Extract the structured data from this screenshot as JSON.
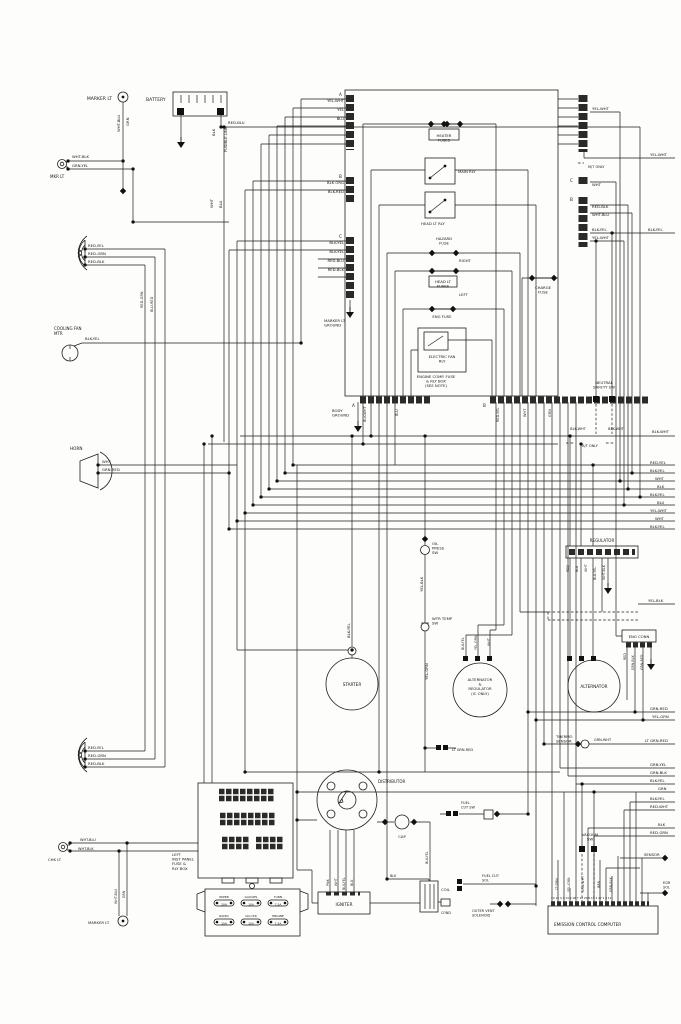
{
  "diagram_type": "automotive wiring diagram",
  "subject": "Engine compartment wiring: battery, engine comp fuse & relay box, starter, alternators, distributor, igniter, emission control computer",
  "diagram": {
    "labels": [
      {
        "n": "marker-lt-top-label",
        "t": "MARKER LT",
        "x": 112,
        "y": 100,
        "a": "e"
      },
      {
        "n": "mkr-lt-label",
        "t": "MKR LT",
        "x": 50,
        "y": 178,
        "s": 4
      },
      {
        "t": "WHT-BLK",
        "x": 72,
        "y": 158,
        "s": 3.8
      },
      {
        "t": "GRN-YEL",
        "x": 72,
        "y": 167,
        "s": 3.8
      },
      {
        "n": "battery-label",
        "t": "BATTERY",
        "x": 146,
        "y": 101
      },
      {
        "t": "RED-BLU",
        "x": 228,
        "y": 124,
        "s": 3.8
      },
      {
        "t": "WHT-BLU",
        "x": 120,
        "y": 132,
        "r": 1,
        "s": 3.8
      },
      {
        "t": "GRN",
        "x": 129,
        "y": 126,
        "r": 1,
        "s": 3.8
      },
      {
        "t": "BLK",
        "x": 215,
        "y": 136,
        "r": 1,
        "s": 3.8
      },
      {
        "t": "FUSIBLE LINK",
        "x": 227,
        "y": 152,
        "r": 1,
        "s": 3.8
      },
      {
        "t": "WHT",
        "x": 213,
        "y": 208,
        "r": 1,
        "s": 3.8
      },
      {
        "t": "BLU",
        "x": 222,
        "y": 208,
        "r": 1,
        "s": 3.8
      },
      {
        "t": "RED-YEL",
        "x": 88,
        "y": 247,
        "s": 3.8
      },
      {
        "t": "RED-GRN",
        "x": 88,
        "y": 255,
        "s": 3.8
      },
      {
        "t": "RED-BLK",
        "x": 88,
        "y": 263,
        "s": 3.8
      },
      {
        "n": "cooling-fan-label",
        "L": [
          "COOLING FAN",
          "MTR"
        ],
        "x": 54,
        "y": 330,
        "s": 4
      },
      {
        "t": "BLK-YEL",
        "x": 85,
        "y": 340,
        "s": 3.8
      },
      {
        "n": "horn-label",
        "t": "HORN",
        "x": 70,
        "y": 450,
        "s": 4.2
      },
      {
        "t": "WHT",
        "x": 102,
        "y": 463,
        "s": 3.8
      },
      {
        "t": "GRN-RED",
        "x": 102,
        "y": 471,
        "s": 3.8
      },
      {
        "t": "A",
        "x": 339,
        "y": 96,
        "s": 4.2
      },
      {
        "t": "YEL-WHT",
        "x": 344,
        "y": 102,
        "a": "e",
        "s": 3.8
      },
      {
        "t": "YEL",
        "x": 344,
        "y": 111,
        "a": "e",
        "s": 3.8
      },
      {
        "t": "BLU",
        "x": 344,
        "y": 120,
        "a": "e",
        "s": 3.8
      },
      {
        "t": "B",
        "x": 339,
        "y": 178,
        "s": 4.2
      },
      {
        "t": "BLK ORG",
        "x": 344,
        "y": 184,
        "a": "e",
        "s": 3.8
      },
      {
        "t": "BLK-RED",
        "x": 344,
        "y": 193,
        "a": "e",
        "s": 3.8
      },
      {
        "t": "C",
        "x": 339,
        "y": 238,
        "s": 4.2
      },
      {
        "t": "BLK-YEL",
        "x": 344,
        "y": 244,
        "a": "e",
        "s": 3.8
      },
      {
        "t": "BLK-YEL",
        "x": 344,
        "y": 253,
        "a": "e",
        "s": 3.8
      },
      {
        "t": "RED-BLU",
        "x": 344,
        "y": 262,
        "a": "e",
        "s": 3.8
      },
      {
        "t": "RED-BLK",
        "x": 344,
        "y": 271,
        "a": "e",
        "s": 3.8
      },
      {
        "n": "marker-lt-ground-label",
        "L": [
          "MARKER LT",
          "GROUND"
        ],
        "x": 324,
        "y": 322,
        "s": 3.8
      },
      {
        "n": "heater-fuses-label",
        "L": [
          "HEATER",
          "FUSES"
        ],
        "x": 444,
        "y": 137,
        "a": "m",
        "s": 3.8
      },
      {
        "n": "main-relay-label",
        "t": "MAIN RLY",
        "x": 458,
        "y": 173,
        "s": 3.8
      },
      {
        "n": "headlight-relay-label",
        "t": "HEAD LT RLY",
        "x": 421,
        "y": 225,
        "s": 3.8
      },
      {
        "n": "hazard-fuse-label",
        "L": [
          "HAZARD",
          "FUSE"
        ],
        "x": 444,
        "y": 240,
        "a": "m",
        "s": 3.8
      },
      {
        "t": "RIGHT",
        "x": 459,
        "y": 262,
        "s": 3.8
      },
      {
        "n": "headlight-fuses-label",
        "L": [
          "HEAD LT",
          "FUSES"
        ],
        "x": 443,
        "y": 283,
        "a": "m",
        "s": 3.8
      },
      {
        "t": "LEFT",
        "x": 459,
        "y": 296,
        "s": 3.8
      },
      {
        "n": "engine-fuse-label",
        "t": "ENG FUSE",
        "x": 442,
        "y": 318,
        "a": "m",
        "s": 3.8
      },
      {
        "n": "electric-fan-relay-label",
        "L": [
          "ELECTRIC FAN",
          "RLY"
        ],
        "x": 442,
        "y": 358,
        "a": "m",
        "s": 3.8
      },
      {
        "n": "engine-comp-box-label",
        "L": [
          "ENGINE COMP. FUSE",
          "& RLY BOX",
          "(SEE NOTE)"
        ],
        "x": 436,
        "y": 378,
        "a": "m",
        "s": 3.8
      },
      {
        "n": "charge-fuse-label",
        "L": [
          "CHARGE",
          "FUSE"
        ],
        "x": 543,
        "y": 289,
        "a": "m",
        "s": 3.8
      },
      {
        "t": "YEL-WHT",
        "x": 592,
        "y": 110,
        "s": 3.8
      },
      {
        "t": "YEL-WHT",
        "x": 650,
        "y": 156,
        "s": 3.8
      },
      {
        "t": "M/T ONLY",
        "x": 588,
        "y": 168,
        "s": 3.5
      },
      {
        "t": "C",
        "x": 570,
        "y": 182,
        "s": 4.2
      },
      {
        "t": "WHT",
        "x": 592,
        "y": 186,
        "s": 3.8
      },
      {
        "t": "B",
        "x": 570,
        "y": 201,
        "s": 4.2
      },
      {
        "t": "RED-BLK",
        "x": 592,
        "y": 208,
        "s": 3.8
      },
      {
        "t": "WHT-BLU",
        "x": 592,
        "y": 216,
        "s": 3.8
      },
      {
        "t": "BLK-YEL",
        "x": 592,
        "y": 231,
        "s": 3.8
      },
      {
        "t": "YEL-WHT",
        "x": 592,
        "y": 239,
        "s": 3.8
      },
      {
        "t": "BLK-YEL",
        "x": 648,
        "y": 231,
        "s": 3.8
      },
      {
        "t": "A",
        "x": 352,
        "y": 407,
        "s": 4.2
      },
      {
        "t": "B",
        "x": 483,
        "y": 407,
        "s": 4.2
      },
      {
        "n": "body-ground-label",
        "L": [
          "BODY",
          "GROUND"
        ],
        "x": 332,
        "y": 412,
        "s": 3.8
      },
      {
        "t": "BLK-WHT",
        "x": 366,
        "y": 422,
        "r": 1,
        "s": 3.5
      },
      {
        "t": "BLU",
        "x": 398,
        "y": 416,
        "r": 1,
        "s": 3.5
      },
      {
        "t": "RED-YEL",
        "x": 499,
        "y": 422,
        "r": 1,
        "s": 3.5
      },
      {
        "t": "WHT",
        "x": 526,
        "y": 417,
        "r": 1,
        "s": 3.5
      },
      {
        "t": "GRN",
        "x": 551,
        "y": 417,
        "r": 1,
        "s": 3.5
      },
      {
        "n": "neutral-safety-sw-label",
        "L": [
          "NEUTRAL",
          "SAFETY SW"
        ],
        "x": 604,
        "y": 384,
        "a": "m",
        "s": 3.8
      },
      {
        "t": "BLK-WHT",
        "x": 578,
        "y": 430,
        "a": "m",
        "s": 3.5
      },
      {
        "t": "BLK-WHT",
        "x": 616,
        "y": 430,
        "a": "m",
        "s": 3.5
      },
      {
        "t": "A/T ONLY",
        "x": 590,
        "y": 447,
        "a": "m",
        "s": 3.5
      },
      {
        "t": "BLK-WHT",
        "x": 652,
        "y": 433,
        "s": 3.8
      },
      {
        "t": "RED-YEL",
        "x": 650,
        "y": 464,
        "s": 3.8
      },
      {
        "t": "BLK-YEL",
        "x": 650,
        "y": 472,
        "s": 3.8
      },
      {
        "t": "WHT",
        "x": 655,
        "y": 480,
        "s": 3.8
      },
      {
        "t": "BLK",
        "x": 657,
        "y": 488,
        "s": 3.8
      },
      {
        "t": "BLK-YEL",
        "x": 650,
        "y": 496,
        "s": 3.8
      },
      {
        "t": "BLU",
        "x": 657,
        "y": 504,
        "s": 3.8
      },
      {
        "t": "YEL-WHT",
        "x": 650,
        "y": 512,
        "s": 3.8
      },
      {
        "t": "WHT",
        "x": 655,
        "y": 520,
        "s": 3.8
      },
      {
        "t": "BLK-YEL",
        "x": 650,
        "y": 528,
        "s": 3.8
      },
      {
        "n": "oil-press-sw-label",
        "L": [
          "OIL",
          "PRESS",
          "SW"
        ],
        "x": 432,
        "y": 545,
        "s": 3.8
      },
      {
        "t": "YEL-BLK",
        "x": 423,
        "y": 592,
        "r": 1,
        "s": 3.8
      },
      {
        "n": "regulator-label",
        "t": "REGULATOR",
        "x": 602,
        "y": 542,
        "a": "m",
        "s": 4
      },
      {
        "t": "RED",
        "x": 569,
        "y": 572,
        "r": 1,
        "s": 3.3
      },
      {
        "t": "BLU",
        "x": 578,
        "y": 572,
        "r": 1,
        "s": 3.3
      },
      {
        "t": "WHT",
        "x": 587,
        "y": 572,
        "r": 1,
        "s": 3.3
      },
      {
        "t": "BLU-YEL",
        "x": 596,
        "y": 580,
        "r": 1,
        "s": 3.3
      },
      {
        "t": "WHT-BLK",
        "x": 605,
        "y": 580,
        "r": 1,
        "s": 3.3
      },
      {
        "t": "YEL-BLK",
        "x": 648,
        "y": 602,
        "s": 3.8
      },
      {
        "n": "water-temp-sw-label",
        "L": [
          "WTR TEMP",
          "SW"
        ],
        "x": 432,
        "y": 620,
        "s": 3.8
      },
      {
        "t": "YEL-GRN",
        "x": 428,
        "y": 680,
        "r": 1,
        "s": 3.8
      },
      {
        "t": "BLK-YEL",
        "x": 350,
        "y": 638,
        "r": 1,
        "s": 3.8
      },
      {
        "n": "starter-label",
        "t": "STARTER",
        "x": 352,
        "y": 686,
        "a": "m",
        "s": 4.2
      },
      {
        "n": "alt-regulator-label",
        "L": [
          "ALTERNATOR",
          "&",
          "REGULATOR",
          "(IC ONLY)"
        ],
        "x": 480,
        "y": 681,
        "a": "m",
        "s": 3.8
      },
      {
        "t": "BLK-YEL",
        "x": 464,
        "y": 650,
        "r": 1,
        "s": 3.3
      },
      {
        "t": "YEL-GRN",
        "x": 477,
        "y": 650,
        "r": 1,
        "s": 3.3
      },
      {
        "t": "WHT",
        "x": 490,
        "y": 646,
        "r": 1,
        "s": 3.3
      },
      {
        "n": "alternator-label",
        "t": "ALTERNATOR",
        "x": 594,
        "y": 688,
        "a": "m",
        "s": 4.2
      },
      {
        "n": "eng-conn-label",
        "t": "ENG CONN",
        "x": 639,
        "y": 638,
        "a": "m",
        "s": 3.8
      },
      {
        "t": "RED",
        "x": 626,
        "y": 660,
        "r": 1,
        "s": 3.3
      },
      {
        "t": "GRN-BLK",
        "x": 634,
        "y": 670,
        "r": 1,
        "s": 3.3
      },
      {
        "t": "GRN-RED",
        "x": 643,
        "y": 670,
        "r": 1,
        "s": 3.3
      },
      {
        "t": "GRN-RED",
        "x": 650,
        "y": 710,
        "s": 3.8
      },
      {
        "t": "YEL-GRN",
        "x": 652,
        "y": 718,
        "s": 3.8
      },
      {
        "n": "thermo-sensor-label",
        "L": [
          "THERMO",
          "SENSOR"
        ],
        "x": 556,
        "y": 738,
        "s": 3.8
      },
      {
        "t": "GRN-WHT",
        "x": 594,
        "y": 741,
        "s": 3.5
      },
      {
        "t": "LT GRN-RED",
        "x": 645,
        "y": 742,
        "s": 3.8
      },
      {
        "t": "LT GRN-RED",
        "x": 452,
        "y": 751,
        "s": 3.5
      },
      {
        "t": "GRN-YEL",
        "x": 650,
        "y": 766,
        "s": 3.8
      },
      {
        "t": "GRN-BLK",
        "x": 650,
        "y": 774,
        "s": 3.8
      },
      {
        "t": "BLK-YEL",
        "x": 650,
        "y": 782,
        "s": 3.8
      },
      {
        "t": "GRN",
        "x": 658,
        "y": 790,
        "s": 3.8
      },
      {
        "t": "BLK-YEL",
        "x": 650,
        "y": 800,
        "s": 3.8
      },
      {
        "t": "RED-WHT",
        "x": 650,
        "y": 808,
        "s": 3.8
      },
      {
        "t": "BLK",
        "x": 658,
        "y": 826,
        "s": 3.8
      },
      {
        "t": "RED-GRN",
        "x": 650,
        "y": 834,
        "s": 3.8
      },
      {
        "n": "vacuum-sw-label",
        "L": [
          "VACUUM",
          "SW"
        ],
        "x": 590,
        "y": 836,
        "a": "m",
        "s": 3.8
      },
      {
        "n": "sensor-label",
        "t": "SENSOR",
        "x": 644,
        "y": 856,
        "s": 3.8
      },
      {
        "n": "egr-sol-label",
        "L": [
          "EGR",
          "SOL"
        ],
        "x": 663,
        "y": 884,
        "s": 3.5
      },
      {
        "t": "LT GRN",
        "x": 558,
        "y": 890,
        "r": 1,
        "s": 3.3
      },
      {
        "t": "YEL-GRN",
        "x": 570,
        "y": 892,
        "r": 1,
        "s": 3.3
      },
      {
        "t": "GRN-WHT",
        "x": 584,
        "y": 892,
        "r": 1,
        "s": 3.3
      },
      {
        "t": "BRN",
        "x": 600,
        "y": 888,
        "r": 1,
        "s": 3.3
      },
      {
        "t": "GRN-BLK",
        "x": 612,
        "y": 892,
        "r": 1,
        "s": 3.3
      },
      {
        "n": "emission-computer-label",
        "t": "EMISSION CONTROL COMPUTER",
        "x": 554,
        "y": 926,
        "s": 4.2
      },
      {
        "n": "computer-pin-numbers",
        "t": "10 15 4 3 14 9 18 7 12 20 5 13 2 17 1 8 11",
        "x": 551,
        "y": 899,
        "s": 2.8
      },
      {
        "n": "distributor-label",
        "t": "DISTRIBUTOR",
        "x": 378,
        "y": 783,
        "s": 4
      },
      {
        "n": "cap-label",
        "t": "CAP",
        "x": 402,
        "y": 838,
        "a": "m",
        "s": 3.8
      },
      {
        "t": "PNK",
        "x": 329,
        "y": 886,
        "r": 1,
        "s": 3.3
      },
      {
        "t": "WHT",
        "x": 337,
        "y": 886,
        "r": 1,
        "s": 3.3
      },
      {
        "t": "BLK-YEL",
        "x": 345,
        "y": 890,
        "r": 1,
        "s": 3.3
      },
      {
        "t": "BLK",
        "x": 353,
        "y": 886,
        "r": 1,
        "s": 3.3
      },
      {
        "n": "igniter-label",
        "t": "IGNITER",
        "x": 344,
        "y": 906,
        "a": "m",
        "s": 4.2
      },
      {
        "t": "BLK",
        "x": 390,
        "y": 877,
        "s": 3.3
      },
      {
        "t": "BLK-YEL",
        "x": 428,
        "y": 864,
        "r": 1,
        "s": 3.3
      },
      {
        "n": "coil-label",
        "t": "COIL",
        "x": 441,
        "y": 891,
        "s": 3.8
      },
      {
        "n": "cond-label",
        "t": "COND",
        "x": 441,
        "y": 914,
        "s": 3.3
      },
      {
        "n": "fuel-cut-sw-label",
        "L": [
          "FUEL",
          "CUT SW"
        ],
        "x": 461,
        "y": 804,
        "s": 3.5
      },
      {
        "n": "fuel-cut-sol-label",
        "L": [
          "FUEL CUT",
          "SOL"
        ],
        "x": 482,
        "y": 877,
        "s": 3.5
      },
      {
        "n": "outer-vent-solenoid-label",
        "L": [
          "OUTER VENT",
          "SOLENOID"
        ],
        "x": 472,
        "y": 912,
        "s": 3.5
      },
      {
        "n": "inst-panel-box-label",
        "L": [
          "LEFT",
          "INST PANEL",
          "FUSE &",
          "RLY BOX"
        ],
        "x": 172,
        "y": 856,
        "s": 3.8
      },
      {
        "n": "fuse-wiper-label",
        "t": "WIPER",
        "x": 224,
        "y": 898,
        "a": "m",
        "s": 3
      },
      {
        "t": "20A",
        "x": 224,
        "y": 905.5,
        "a": "m",
        "s": 3
      },
      {
        "n": "fuse-gauges-label",
        "t": "GAUGES",
        "x": 251,
        "y": 898,
        "a": "m",
        "s": 3
      },
      {
        "t": "10A",
        "x": 251,
        "y": 905.5,
        "a": "m",
        "s": 3
      },
      {
        "n": "fuse-turn-label",
        "t": "TURN",
        "x": 278,
        "y": 898,
        "a": "m",
        "s": 3
      },
      {
        "t": "7.5A",
        "x": 278,
        "y": 905.5,
        "a": "m",
        "s": 3
      },
      {
        "n": "fuse-radio-label",
        "t": "RADIO",
        "x": 224,
        "y": 917,
        "a": "m",
        "s": 3
      },
      {
        "t": "15A",
        "x": 224,
        "y": 924.5,
        "a": "m",
        "s": 3
      },
      {
        "n": "fuse-cig-ltr-label",
        "t": "CIG LTR",
        "x": 251,
        "y": 917,
        "a": "m",
        "s": 3
      },
      {
        "t": "15A",
        "x": 251,
        "y": 924.5,
        "a": "m",
        "s": 3
      },
      {
        "n": "fuse-engine-label",
        "t": "ENGINE",
        "x": 278,
        "y": 917,
        "a": "m",
        "s": 3
      },
      {
        "t": "7.5A",
        "x": 278,
        "y": 924.5,
        "a": "m",
        "s": 3
      },
      {
        "n": "chk-lt-label",
        "t": "CHK LT",
        "x": 48,
        "y": 861,
        "s": 3.8
      },
      {
        "t": "WHT-BLU",
        "x": 80,
        "y": 841,
        "s": 3.5
      },
      {
        "t": "WHT-BLK",
        "x": 78,
        "y": 850,
        "s": 3.5
      },
      {
        "n": "marker-lt-bottom-label",
        "t": "MARKER LT",
        "x": 88,
        "y": 924,
        "s": 3.8
      },
      {
        "t": "WHT-BLU",
        "x": 117,
        "y": 904,
        "r": 1,
        "s": 3.3
      },
      {
        "t": "GRN",
        "x": 125,
        "y": 898,
        "r": 1,
        "s": 3.3
      },
      {
        "t": "RED-YEL",
        "x": 88,
        "y": 749,
        "s": 3.8
      },
      {
        "t": "RED-GRN",
        "x": 88,
        "y": 757,
        "s": 3.8
      },
      {
        "t": "RED-BLK",
        "x": 88,
        "y": 765,
        "s": 3.8
      },
      {
        "t": "RED-GRN",
        "x": 143,
        "y": 308,
        "r": 1,
        "s": 3.5
      },
      {
        "t": "BLU-RED",
        "x": 153,
        "y": 312,
        "r": 1,
        "s": 3.5
      }
    ]
  }
}
